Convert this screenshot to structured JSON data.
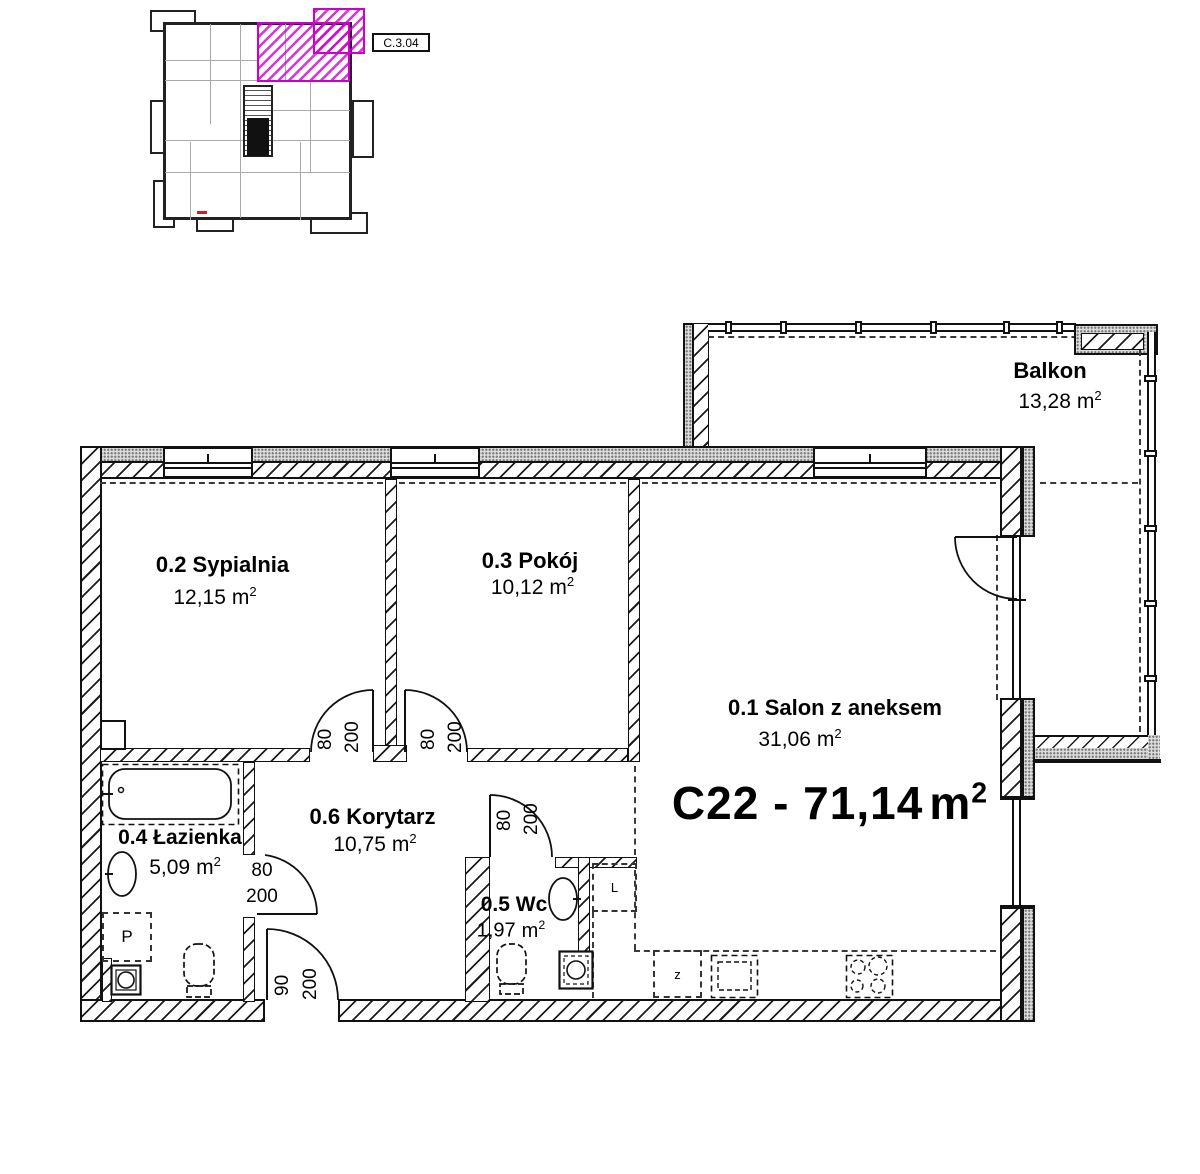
{
  "meta": {
    "title": "C22 - 71,14",
    "unit": "m",
    "sup": "2"
  },
  "overview": {
    "unit_label": "C.3.04"
  },
  "balcony": {
    "name": "Balkon",
    "area": "13,28"
  },
  "rooms": [
    {
      "name": "0.1 Salon z aneksem",
      "area": "31,06"
    },
    {
      "name": "0.2 Sypialnia",
      "area": "12,15"
    },
    {
      "name": "0.3 Pokój",
      "area": "10,12"
    },
    {
      "name": "0.4 Łazienka",
      "area": "5,09"
    },
    {
      "name": "0.5 Wc",
      "area": "1,97"
    },
    {
      "name": "0.6 Korytarz",
      "area": "10,75"
    }
  ],
  "doors": {
    "bedroom": {
      "w": "80",
      "h": "200"
    },
    "room": {
      "w": "80",
      "h": "200"
    },
    "wc": {
      "w": "80",
      "h": "200"
    },
    "bathroom": {
      "w": "80",
      "h": "200"
    },
    "entrance": {
      "w": "90",
      "h": "200"
    }
  },
  "fixtures": {
    "washer": "P",
    "fridge": "L",
    "dishwasher": "z"
  },
  "colors": {
    "highlight": "#cc00cc"
  }
}
